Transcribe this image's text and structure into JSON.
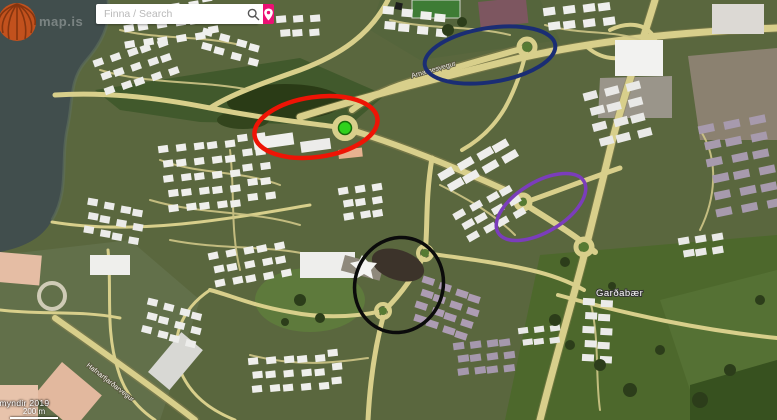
{
  "header": {
    "logo_wordmark": "map.is",
    "search": {
      "placeholder": "Finna / Search"
    },
    "accent_pink": "#ec1074"
  },
  "map": {
    "labels": {
      "city": "Garðabær",
      "road_top": "Arnarnesvegur",
      "road_bottom": "Hafnarfjarðarvegur"
    },
    "attribution": "Loftmyndir 2019",
    "scale_label": "200 m"
  },
  "annotations": {
    "red_ellipse": {
      "color": "#ee1405"
    },
    "navy_ellipse": {
      "color": "#1a2d74"
    },
    "purple_ellipse": {
      "color": "#7b3dbb"
    },
    "black_ellipse": {
      "color": "#0b0b0b"
    },
    "green_marker": {
      "color": "#2fd11c"
    }
  }
}
